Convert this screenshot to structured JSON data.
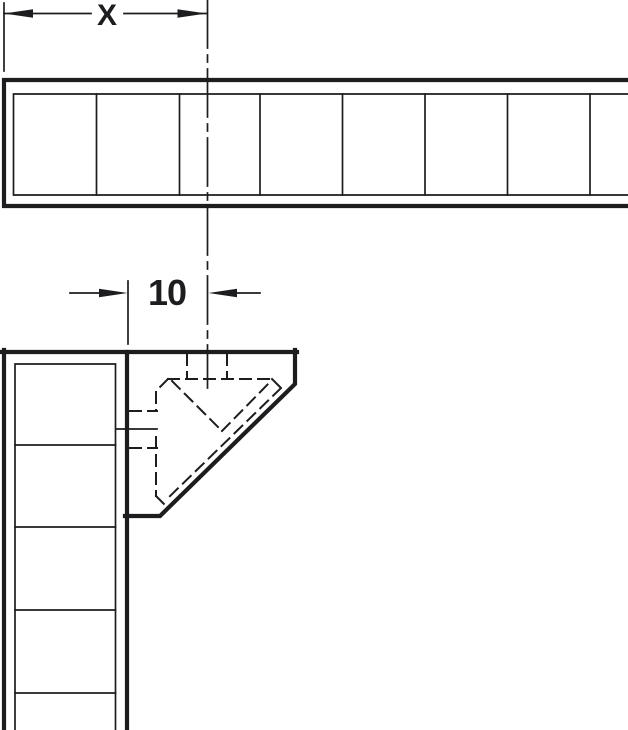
{
  "drawing": {
    "labels": {
      "x_dimension": "X",
      "offset_dimension": "10"
    },
    "colors": {
      "ink": "#1d1d1f",
      "background": "#ffffff"
    }
  }
}
